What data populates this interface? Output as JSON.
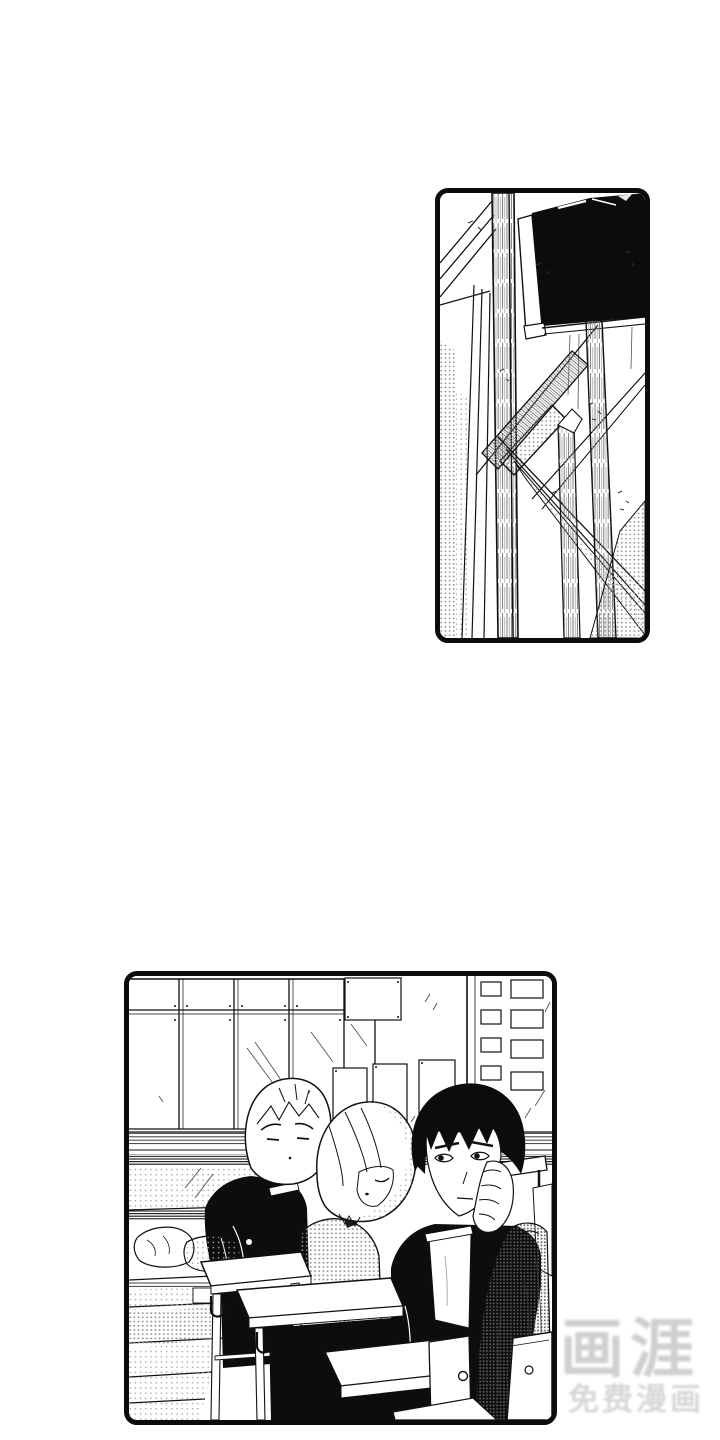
{
  "page": {
    "background_color": "#ffffff",
    "ink_color": "#0c0c0c",
    "halftone_color": "#8f8f8f"
  },
  "panels": [
    {
      "id": "panel-1",
      "alt": "Tilted upward view of a school building corner: blank black signboard, white wooden posts, slanted beams and halftone shading"
    },
    {
      "id": "panel-2",
      "alt": "Classroom scene: windows and bulletin papers on the back wall, a blond student slouching, a girl asleep, and a dark-haired student resting his cheek on his hand at their desks"
    }
  ],
  "watermark": {
    "title": "画涯",
    "subtitle": "免费漫画",
    "title_color": "#cfcfcf",
    "subtitle_color": "#d7d7d7"
  }
}
